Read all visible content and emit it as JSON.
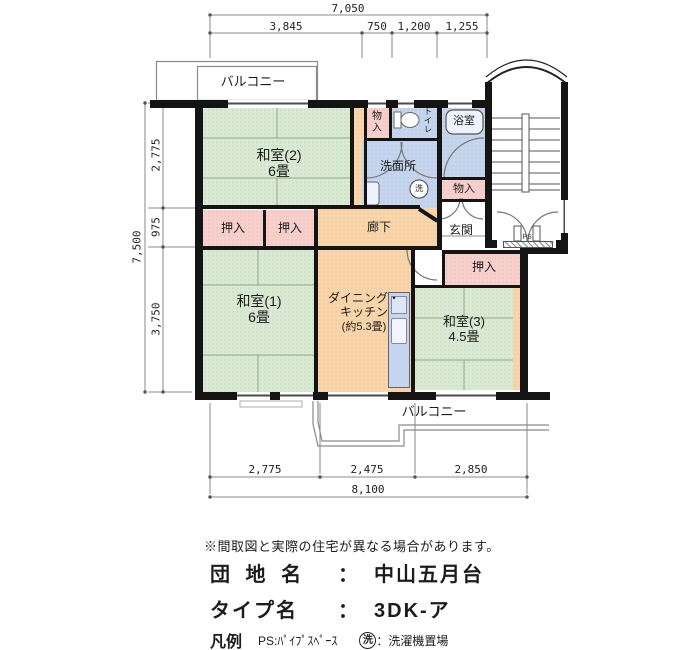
{
  "plan": {
    "balcony_top_label": "バルコニー",
    "balcony_bottom_label": "バルコニー",
    "rooms": {
      "washitsu2_name": "和室(2)",
      "washitsu2_size": "6畳",
      "washitsu1_name": "和室(1)",
      "washitsu1_size": "6畳",
      "washitsu3_name": "和室(3)",
      "washitsu3_size": "4.5畳",
      "dk_name_line1": "ダイニング・",
      "dk_name_line2": "キッチン",
      "dk_size": "(約5.3畳)",
      "senmenjo": "洗面所",
      "yokushitsu": "浴室",
      "toilet": "トイレ",
      "genkan": "玄関",
      "rouka": "廊下",
      "oshiire": "押入",
      "monoiri": "物入",
      "ps": "PS",
      "washer": "洗"
    },
    "dimensions": {
      "top_total": "7,050",
      "top_seg1": "3,845",
      "top_seg2": "750",
      "top_seg3": "1,200",
      "top_seg4": "1,255",
      "left_total": "7,500",
      "left_seg1": "2,775",
      "left_seg2": "975",
      "left_seg3": "3,750",
      "bottom_seg1": "2,775",
      "bottom_seg2": "2,475",
      "bottom_seg3": "2,850",
      "bottom_total": "8,100"
    }
  },
  "info": {
    "disclaimer": "※間取図と実際の住宅が異なる場合があります。",
    "estate_label": "団 地 名",
    "estate_colon": "：",
    "estate_value": "中山五月台",
    "type_label": "タイプ名",
    "type_colon": "：",
    "type_value": "3DK-ア",
    "legend_label": "凡例",
    "legend_ps_text": "PS:ﾊﾟｲﾌﾟｽﾍﾟｰｽ",
    "legend_washer_mark": "洗",
    "legend_washer_text": "：洗濯機置場"
  },
  "colors": {
    "tatami": "#d9e9d3",
    "closet": "#f7d0cc",
    "floor": "#f8d5aa",
    "wet": "#c6d5ee",
    "wall": "#141414"
  }
}
